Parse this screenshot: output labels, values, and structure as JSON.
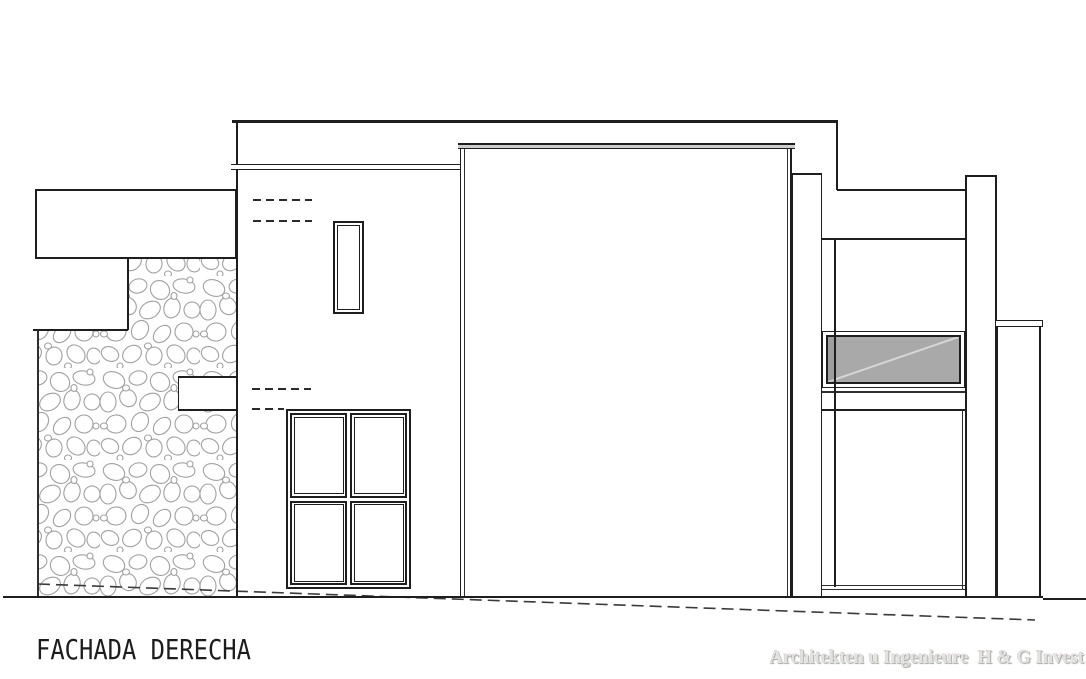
{
  "drawing": {
    "title": "FACHADA DERECHA",
    "watermark": "Architekten u Ingenieure  H & G Invest"
  },
  "colors": {
    "background": "#ffffff",
    "line": "#1e1e1e",
    "stone_outline": "#a0a0a0",
    "glass_gray": "#a9a9a9",
    "cap_gray": "#cdcdcd",
    "watermark_gray": "#e3e3e3"
  }
}
